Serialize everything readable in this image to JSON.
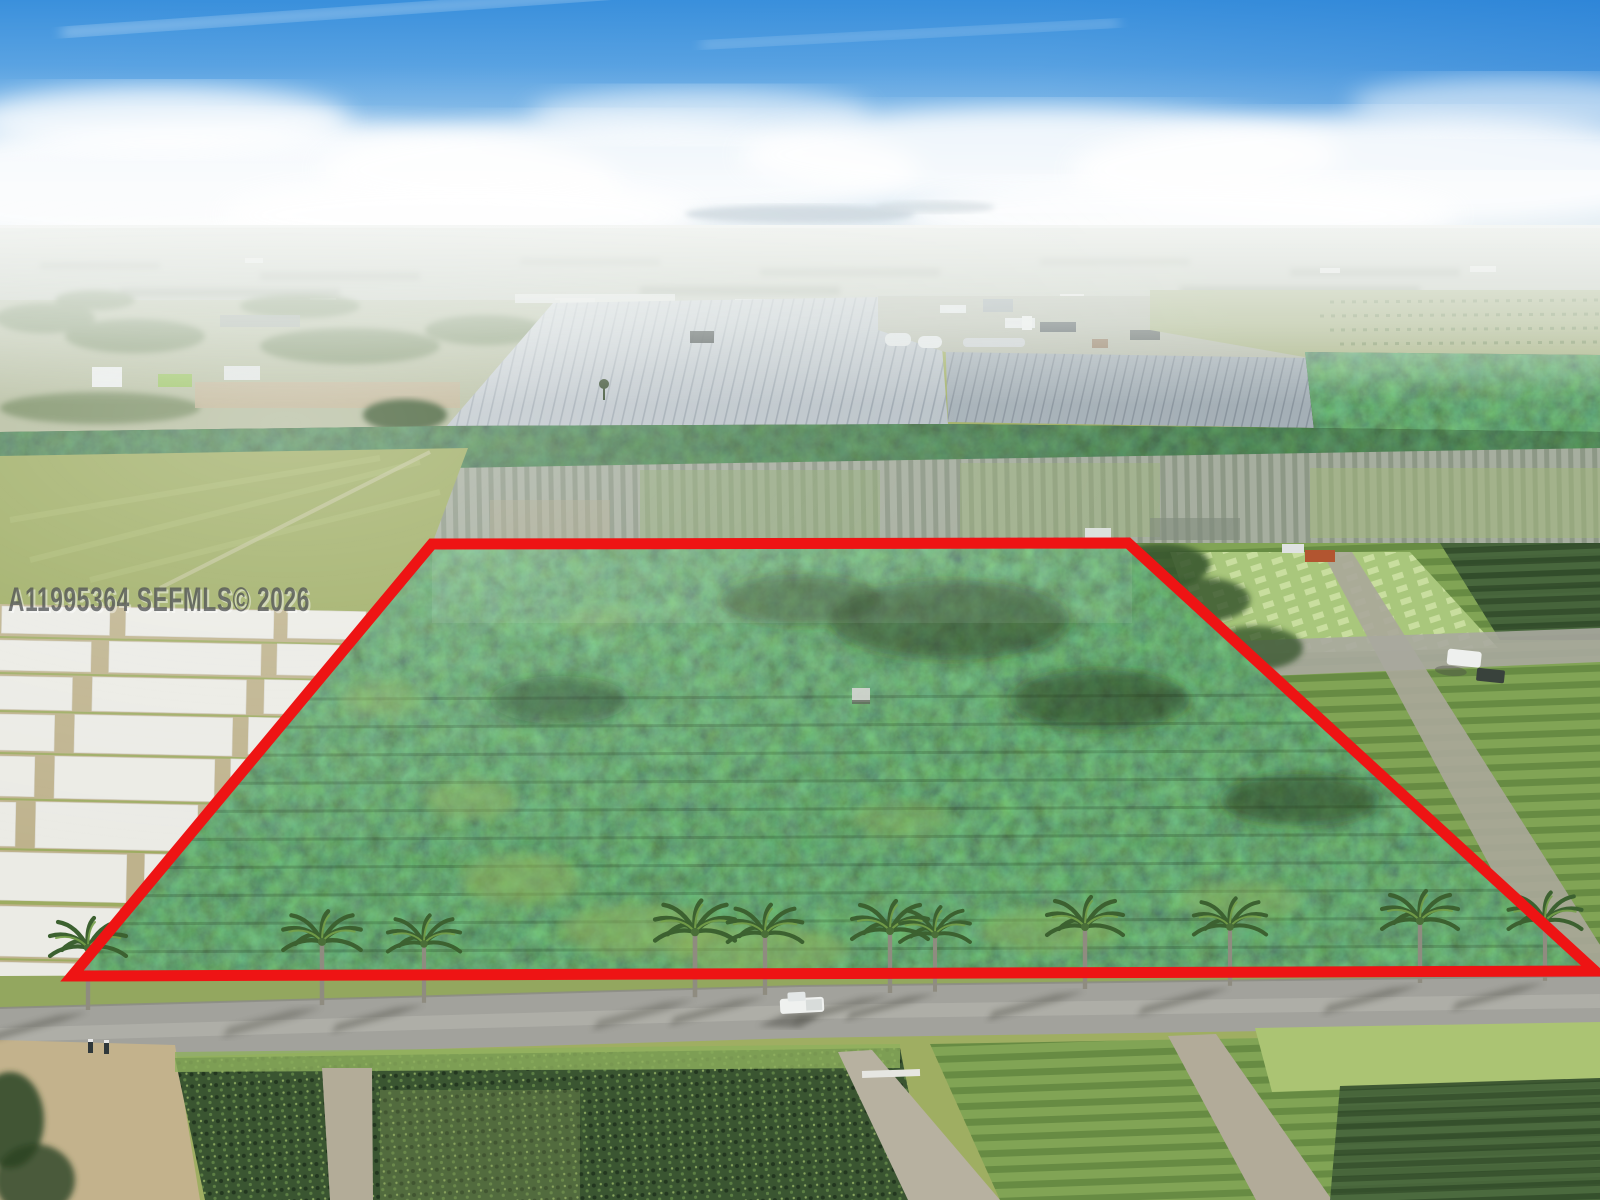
{
  "watermark": {
    "text": "A11995364  SEFMLS© 2026",
    "mls_number": "A11995364",
    "source": "SEFMLS©",
    "year": "2026"
  },
  "boundary": {
    "points_attr": "432,544 1128,543 1595,971 72,976",
    "color": "#ee1414",
    "stroke_width": "11"
  },
  "palette": {
    "sky_blue": "#3a90dc",
    "haze_white": "#f2f4f2",
    "grove_green": "#3c5a2e",
    "grass_green": "#9dac62",
    "plot_white": "#ebebe5",
    "road_gray": "#a2a29c",
    "palm_green": "#3c6130",
    "greenhouse_gray": "#b7c0c6"
  }
}
